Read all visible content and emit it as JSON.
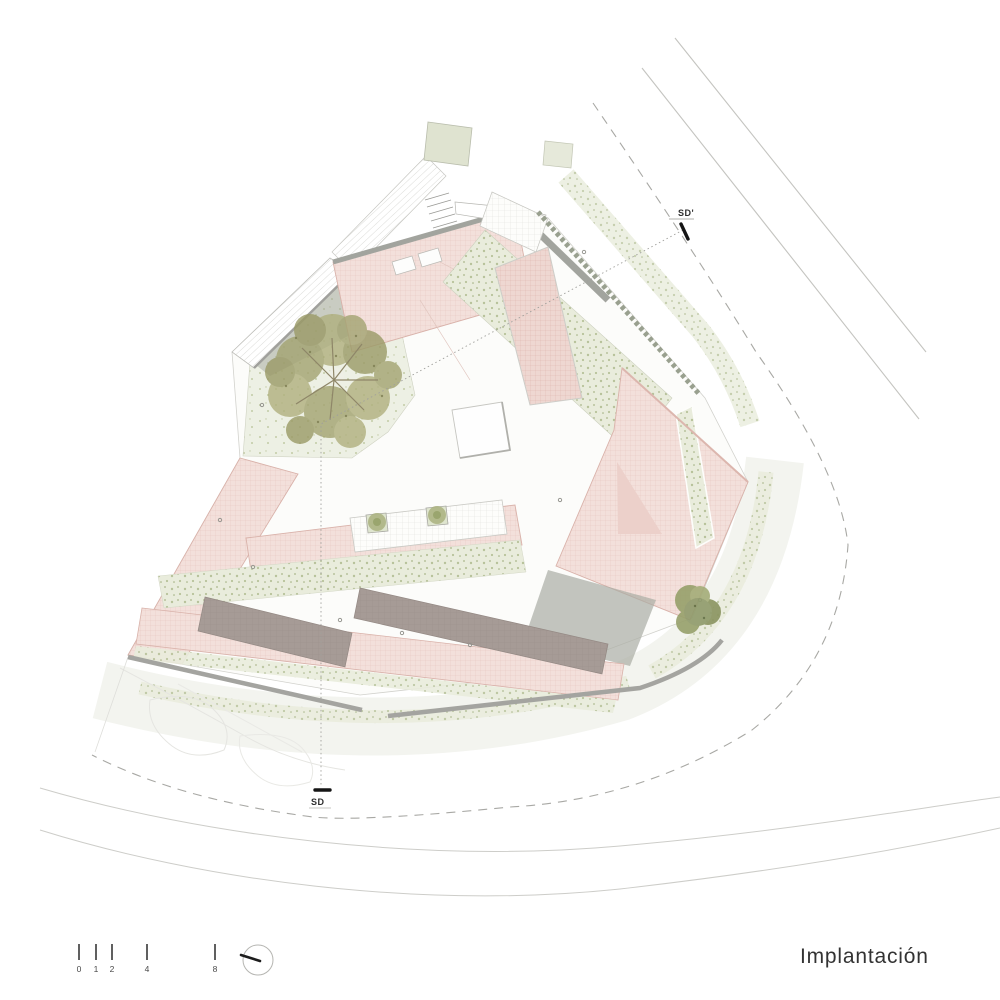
{
  "title": {
    "label": "Implantación"
  },
  "section_markers": {
    "top": {
      "label": "SD'"
    },
    "bottom": {
      "label": "SD"
    }
  },
  "scale_bar": {
    "labels": [
      "0",
      "1",
      "2",
      "4",
      "8"
    ]
  },
  "compass": {
    "icon": "north-arrow-circle"
  },
  "drawing": {
    "type": "architectural-site-plan",
    "elements": [
      "roads",
      "plot-boundary-dashed",
      "building-roofs",
      "courtyard-garden",
      "trees",
      "skylight",
      "terrace-planters",
      "section-line"
    ]
  },
  "palette": {
    "roof_pink": "#f3e0db",
    "roof_pink_deep": "#eed7d1",
    "roof_fascia_pink": "#dcb3ab",
    "roof_dark": "#a69b96",
    "parapet_gray": "#a2a49e",
    "sage_green": "#e9ecdc",
    "tree_khaki": "#a8a872",
    "hedge_green": "#99a08f",
    "line_gray": "#c4c4c0",
    "text_dark": "#333333"
  }
}
